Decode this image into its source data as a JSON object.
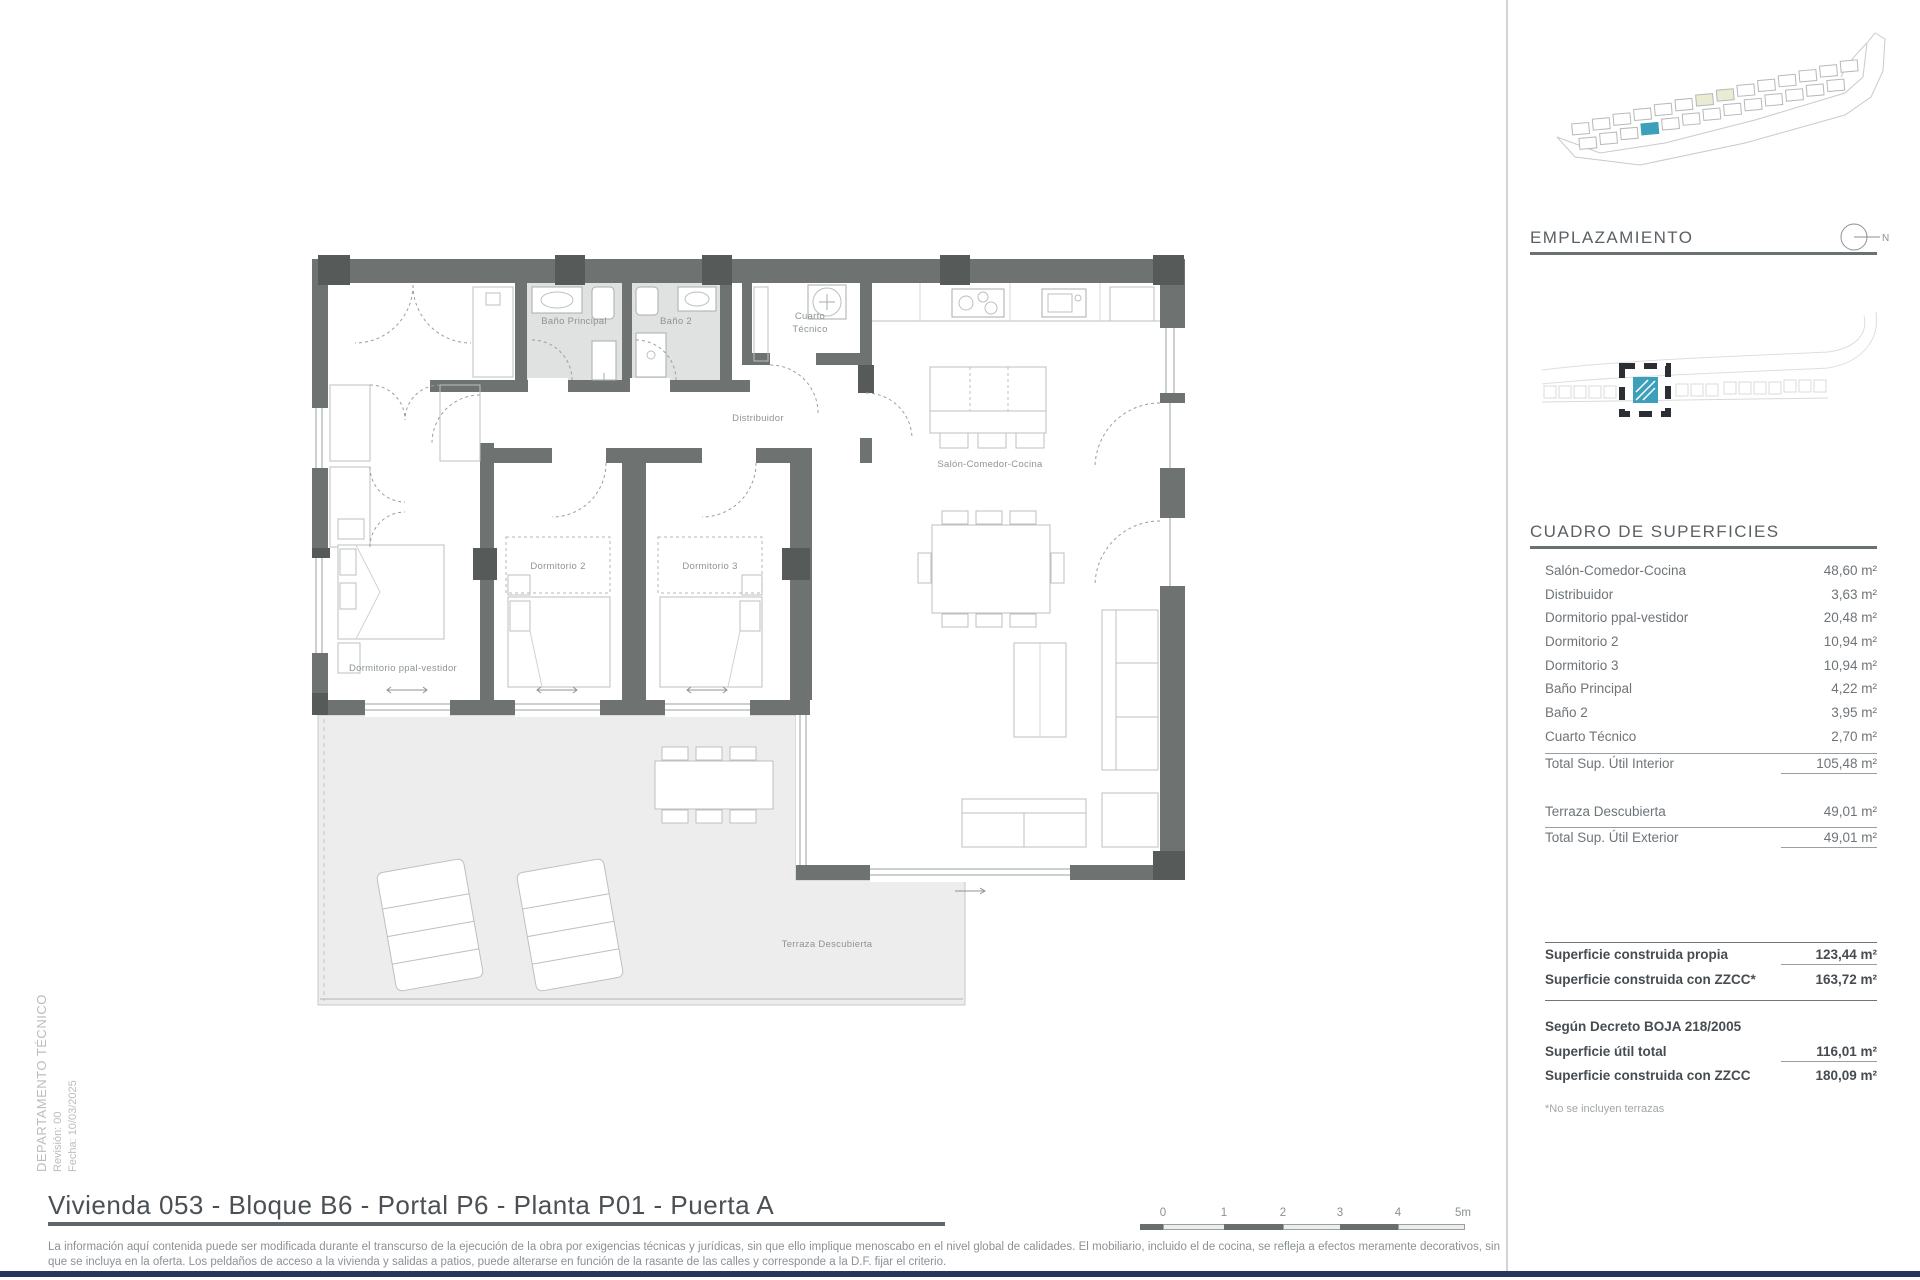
{
  "meta": {
    "department": "DEPARTAMENTO TÉCNICO",
    "revision": "Revisión: 00",
    "date": "Fecha: 10/03/2025"
  },
  "title": "Vivienda 053 - Bloque B6 - Portal P6 - Planta P01 - Puerta A",
  "disclaimer": "La información aquí contenida puede ser modificada durante el transcurso de la ejecución de la obra por exigencias técnicas y jurídicas, sin que ello implique menoscabo en el nivel global de calidades. El mobiliario, incluido el de cocina, se refleja a efectos meramente decorativos, sin que se incluya en la oferta. Los peldaños de acceso a la vivienda y salidas a patios, puede alterarse en función de la rasante de las calles y corresponde a la D.F. fijar el criterio.",
  "scalebar": {
    "labels": [
      "0",
      "1",
      "2",
      "3",
      "4",
      "5m"
    ]
  },
  "sidebar": {
    "emplazamiento_heading": "EMPLAZAMIENTO",
    "north_label": "N",
    "surfaces_heading": "CUADRO DE SUPERFICIES",
    "rows": [
      {
        "label": "Salón-Comedor-Cocina",
        "value": "48,60 m²"
      },
      {
        "label": "Distribuidor",
        "value": "3,63 m²"
      },
      {
        "label": "Dormitorio ppal-vestidor",
        "value": "20,48 m²"
      },
      {
        "label": "Dormitorio 2",
        "value": "10,94 m²"
      },
      {
        "label": "Dormitorio 3",
        "value": "10,94 m²"
      },
      {
        "label": "Baño Principal",
        "value": "4,22 m²"
      },
      {
        "label": "Baño 2",
        "value": "3,95 m²"
      },
      {
        "label": "Cuarto Técnico",
        "value": "2,70 m²"
      }
    ],
    "interior_total": {
      "label": "Total Sup. Útil Interior",
      "value": "105,48 m²"
    },
    "terrace_row": {
      "label": "Terraza Descubierta",
      "value": "49,01 m²"
    },
    "exterior_total": {
      "label": "Total Sup. Útil Exterior",
      "value": "49,01 m²"
    },
    "built_rows": [
      {
        "label": "Superficie construida propia",
        "value": "123,44 m²"
      },
      {
        "label": "Superficie construida con ZZCC*",
        "value": "163,72 m²"
      }
    ],
    "decree_heading": "Según Decreto BOJA 218/2005",
    "decree_rows": [
      {
        "label": "Superficie útil total",
        "value": "116,01 m²"
      },
      {
        "label": "Superficie construida con ZZCC",
        "value": "180,09 m²"
      }
    ],
    "footnote": "*No se incluyen terrazas"
  },
  "plan_labels": {
    "bano_principal": "Baño Principal",
    "bano2": "Baño 2",
    "cuarto_l1": "Cuarto",
    "cuarto_l2": "Técnico",
    "distribuidor": "Distribuidor",
    "salon": "Salón-Comedor-Cocina",
    "dorm2": "Dormitorio 2",
    "dorm3": "Dormitorio 3",
    "dorm_ppal": "Dormitorio ppal-vestidor",
    "terraza": "Terraza Descubierta"
  },
  "colors": {
    "accent_teal": "#3da0bb",
    "footer_navy": "#26375a",
    "wall_gray": "#6e7372"
  }
}
